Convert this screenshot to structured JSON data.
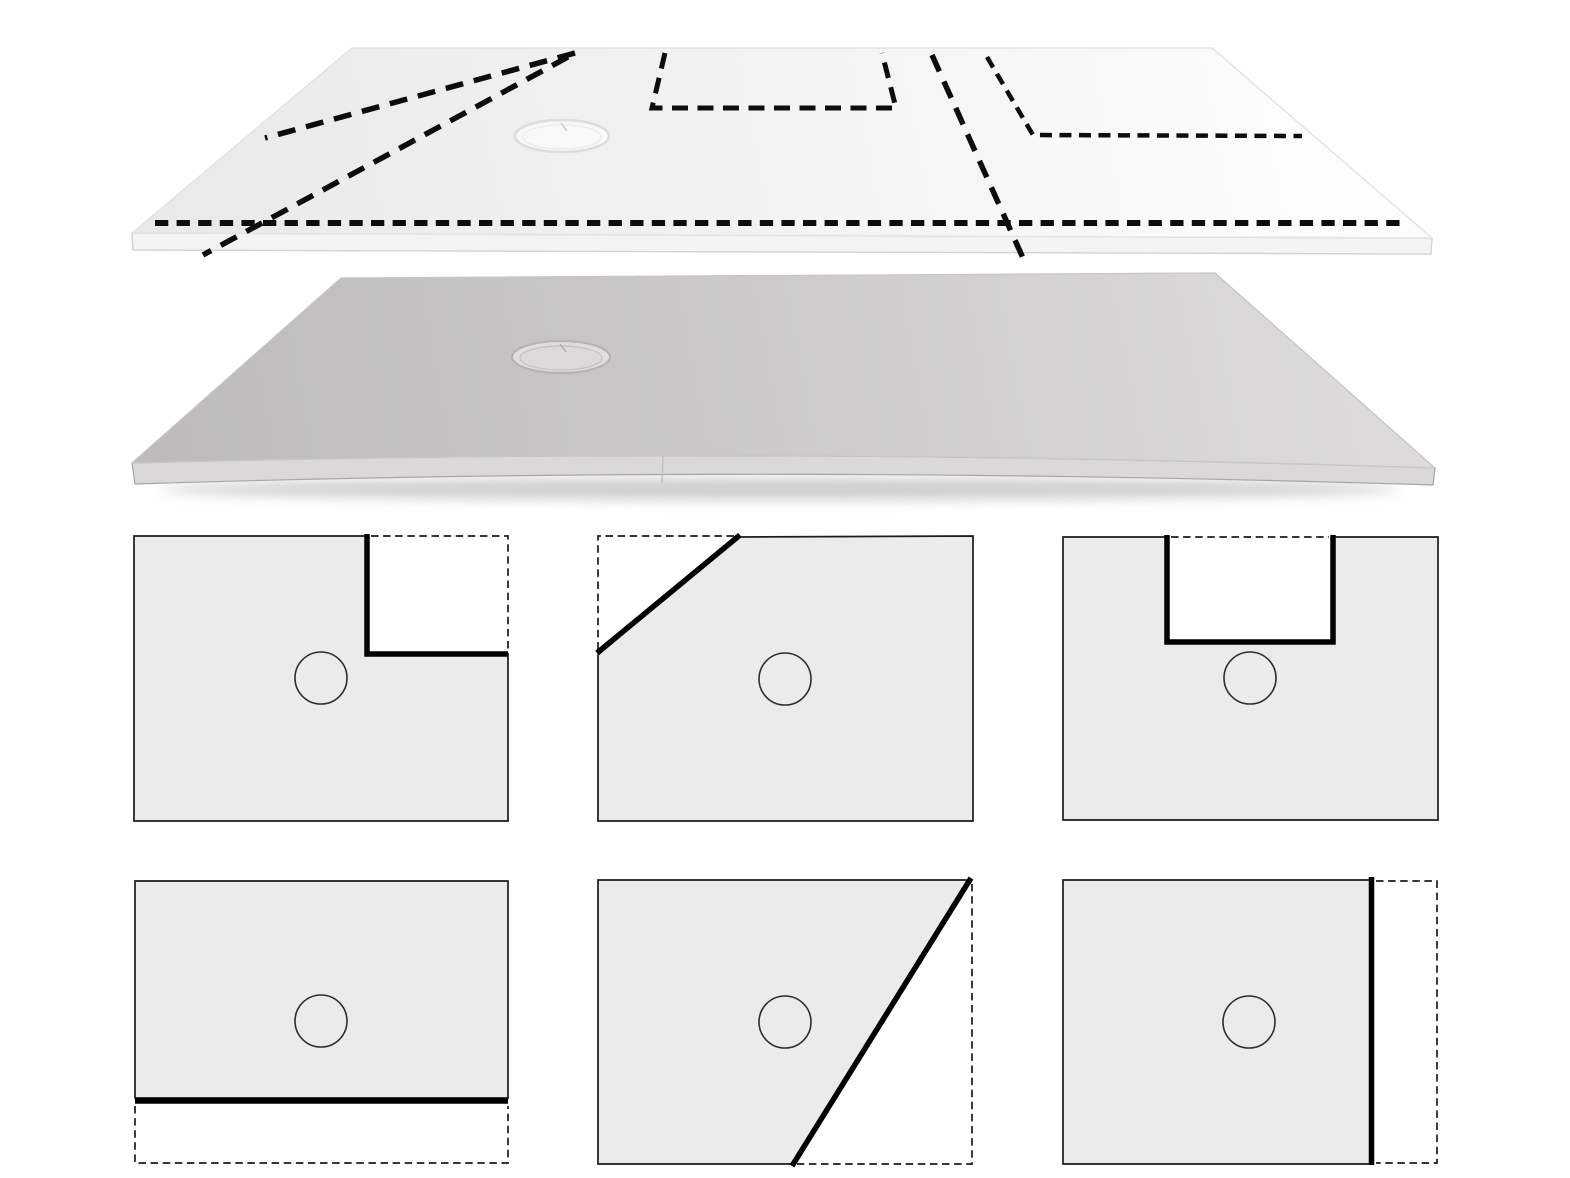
{
  "canvas": {
    "width": 1570,
    "height": 1178,
    "background": "#ffffff"
  },
  "colors": {
    "cut_line": "#0d0d0d",
    "diagram_fill": "#ebebeb",
    "diagram_stroke": "#1b1b1b",
    "diagram_cut": "#000000",
    "diagram_circle": "#2e2e2e",
    "white_surface_light": "#fcfcfb",
    "white_surface_mid": "#f3f3f2",
    "white_surface_dark": "#e9e9e8",
    "white_face": "#f4f4f3",
    "white_face_edge": "#d3d3d2",
    "white_outline": "#e2e2e1",
    "gray_surface_light": "#dcdbd9",
    "gray_surface_mid": "#cbcac8",
    "gray_surface_dark": "#bdbcba",
    "gray_face": "#dad9d7",
    "gray_face_edge": "#a7a6a4",
    "gray_outline": "#c7c6c4",
    "gray_seam": "#c2c1bf",
    "shadow": "#a8a7a5",
    "drain_white_fill": "#f8f8f7",
    "drain_white_stroke": "#dcdcdb",
    "drain_white_inner_fill": "#f9f9f8",
    "drain_white_inner_stroke": "#ebebea",
    "drain_white_tick": "#c8c8c7",
    "drain_gray_fill": "#e0dfdd",
    "drain_gray_stroke": "#b5b4b2",
    "drain_gray_inner_fill": "#dcdbd9",
    "drain_gray_inner_stroke": "#c5c4c2",
    "drain_gray_tick": "#a5a4a2"
  },
  "top_tray": {
    "name": "top-tray-with-cut-markings",
    "surface_path": "M352,48 L1212,48 L1432,238 L132,233 Z",
    "face_path": "M132,233 L1432,238 L1431,254 L133,250 Z",
    "drain": {
      "cx": 562,
      "cy": 136,
      "rx": 47,
      "ry": 16
    },
    "cut_lines": [
      {
        "name": "cut-line-diagonal-short-left",
        "points": [
          [
            575,
            53
          ],
          [
            265,
            138
          ]
        ],
        "dash": "18 11",
        "width": 5.5
      },
      {
        "name": "cut-line-diagonal-long-left",
        "points": [
          [
            568,
            57
          ],
          [
            203,
            255
          ]
        ],
        "dash": "18 11",
        "width": 5.5
      },
      {
        "name": "cut-line-front-strip",
        "points": [
          [
            155,
            223
          ],
          [
            1403,
            223
          ]
        ],
        "dash": "13.3 8.3",
        "width": 6
      },
      {
        "name": "cut-line-u-notch",
        "points": [
          [
            665,
            53
          ],
          [
            652,
            108
          ],
          [
            896,
            108
          ],
          [
            882,
            53
          ]
        ],
        "dash": "16 9.5",
        "width": 5
      },
      {
        "name": "cut-line-right-diagonal",
        "points": [
          [
            932,
            55
          ],
          [
            1023,
            258
          ]
        ],
        "dash": "18 11",
        "width": 5.5
      },
      {
        "name": "cut-line-corner-notch",
        "points": [
          [
            987,
            57
          ],
          [
            1033,
            135
          ],
          [
            1302,
            136
          ]
        ],
        "dash": "12 7.5",
        "width": 4.5
      }
    ]
  },
  "bottom_tray": {
    "name": "bottom-tray-plain",
    "surface_path": "M341,278 L1215,273 L1435,468 Q760,446 132,463 Z",
    "face_path": "M132,463 Q760,446 1435,468 L1433,485 Q760,464 135,484 Z",
    "seam": {
      "x1": 663,
      "y1": 456,
      "x2": 662,
      "y2": 483
    },
    "shadow": {
      "cx": 780,
      "cy": 489,
      "rx": 620,
      "ry": 11
    },
    "drain": {
      "cx": 561,
      "cy": 357,
      "rx": 49,
      "ry": 16
    }
  },
  "diagrams": [
    {
      "name": "cut-option-notch-top-right",
      "shape": [
        [
          134,
          536
        ],
        [
          367,
          536
        ],
        [
          367,
          654
        ],
        [
          508,
          654
        ],
        [
          508,
          821
        ],
        [
          134,
          821
        ]
      ],
      "cut": [
        [
          367,
          534
        ],
        [
          367,
          654
        ],
        [
          508,
          654
        ]
      ],
      "dashed": [
        [
          371,
          536
        ],
        [
          508,
          536
        ],
        [
          508,
          651
        ]
      ],
      "drain": {
        "cx": 321,
        "cy": 678,
        "r": 26
      }
    },
    {
      "name": "cut-option-diagonal-top-left",
      "shape": [
        [
          738,
          537
        ],
        [
          973,
          536
        ],
        [
          973,
          821
        ],
        [
          598,
          821
        ],
        [
          598,
          655
        ]
      ],
      "cut": [
        [
          740,
          535
        ],
        [
          597,
          653
        ]
      ],
      "dashed": [
        [
          734,
          536
        ],
        [
          598,
          536
        ],
        [
          598,
          652
        ]
      ],
      "drain": {
        "cx": 785,
        "cy": 679,
        "r": 26
      }
    },
    {
      "name": "cut-option-u-notch-top",
      "shape": [
        [
          1063,
          537
        ],
        [
          1167,
          537
        ],
        [
          1167,
          642
        ],
        [
          1333,
          642
        ],
        [
          1333,
          537
        ],
        [
          1438,
          537
        ],
        [
          1438,
          820
        ],
        [
          1063,
          820
        ]
      ],
      "cut": [
        [
          1167,
          535
        ],
        [
          1167,
          642
        ],
        [
          1333,
          642
        ],
        [
          1333,
          535
        ]
      ],
      "dashed": [
        [
          1171,
          537
        ],
        [
          1329,
          537
        ]
      ],
      "drain": {
        "cx": 1250,
        "cy": 678,
        "r": 26
      }
    },
    {
      "name": "cut-option-strip-bottom",
      "shape": [
        [
          135,
          881
        ],
        [
          508,
          881
        ],
        [
          508,
          1098
        ],
        [
          135,
          1098
        ]
      ],
      "cut": [
        [
          135,
          1101
        ],
        [
          508,
          1101
        ]
      ],
      "dashed": [
        [
          135,
          1106
        ],
        [
          135,
          1163
        ],
        [
          508,
          1163
        ],
        [
          508,
          1106
        ]
      ],
      "drain": {
        "cx": 321,
        "cy": 1021,
        "r": 26
      }
    },
    {
      "name": "cut-option-diagonal-bottom-right",
      "shape": [
        [
          598,
          880
        ],
        [
          971,
          880
        ],
        [
          793,
          1164
        ],
        [
          598,
          1164
        ]
      ],
      "cut": [
        [
          971,
          878
        ],
        [
          792,
          1166
        ]
      ],
      "dashed": [
        [
          972,
          884
        ],
        [
          972,
          1164
        ],
        [
          797,
          1164
        ]
      ],
      "drain": {
        "cx": 785,
        "cy": 1022,
        "r": 26
      }
    },
    {
      "name": "cut-option-strip-right",
      "shape": [
        [
          1063,
          880
        ],
        [
          1370,
          880
        ],
        [
          1370,
          1164
        ],
        [
          1063,
          1164
        ]
      ],
      "cut": [
        [
          1371.5,
          877
        ],
        [
          1371.5,
          1165
        ]
      ],
      "dashed": [
        [
          1376,
          881
        ],
        [
          1437,
          881
        ],
        [
          1437,
          1163
        ],
        [
          1376,
          1163
        ]
      ],
      "drain": {
        "cx": 1249,
        "cy": 1022,
        "r": 26
      }
    }
  ]
}
